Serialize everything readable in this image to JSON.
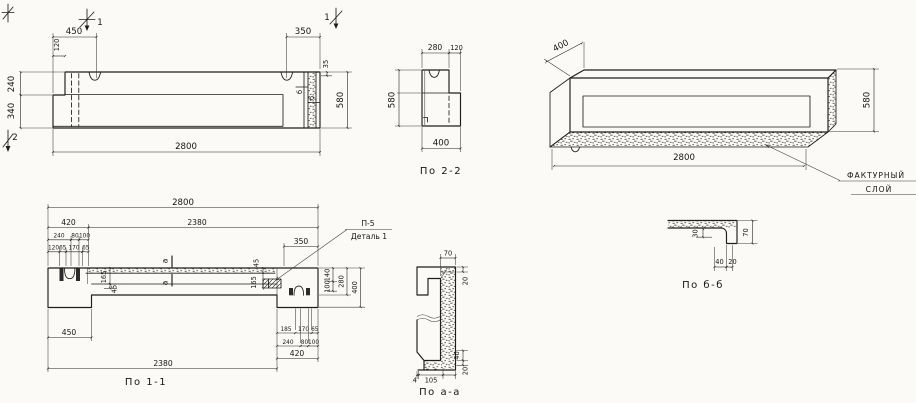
{
  "style": {
    "ink": "#1d1d1d",
    "paper": "#fbfaf6"
  },
  "views": {
    "elevation": {
      "marker_1_left": "1",
      "marker_1_right": "1",
      "marker_2": "2",
      "dim_450": "450",
      "dim_120": "120",
      "dim_350": "350",
      "dim_35": "35",
      "dim_580": "580",
      "dim_2800": "2800",
      "dim_240": "240",
      "dim_340": "340",
      "cut_label_b1": "б",
      "cut_label_b2": "б"
    },
    "section_2_2": {
      "title": "По 2-2",
      "dim_280": "280",
      "dim_120": "120",
      "dim_580": "580",
      "dim_400": "400"
    },
    "axonometric": {
      "dim_400": "400",
      "dim_580": "580",
      "dim_2800": "2800",
      "callout_line1": "ФАКТУРНЫЙ",
      "callout_line2": "СЛОЙ"
    },
    "plan_1_1": {
      "title": "По 1-1",
      "dim_2800": "2800",
      "dim_420_top": "420",
      "dim_2380_top": "2380",
      "dim_240_top": "240",
      "dim_80_top": "80",
      "dim_100_top": "100",
      "dim_120": "120",
      "dim_65_a": "65",
      "dim_170_top": "170",
      "dim_65_b": "65",
      "dim_165_left": "165",
      "dim_45_left": "45",
      "cut_label_a1": "а",
      "cut_label_a2": "а",
      "dim_350": "350",
      "detail_tag": "П-5",
      "detail_name": "Деталь 1",
      "dim_45_right": "45",
      "dim_165_right": "165",
      "dim_140": "140",
      "dim_100_right": "100",
      "dim_280": "280",
      "dim_400": "400",
      "dim_185": "185",
      "dim_170_bot": "170",
      "dim_65_bot": "65",
      "dim_240_bot": "240",
      "dim_80_bot": "80",
      "dim_100_bot": "100",
      "dim_420_bot": "420",
      "dim_450": "450",
      "dim_2380_bot": "2380"
    },
    "section_a_a": {
      "title": "По а-а",
      "dim_70": "70",
      "dim_20_top": "20",
      "dim_40": "40",
      "dim_20_bot": "20",
      "dim_4": "4",
      "dim_105": "105"
    },
    "section_b_b": {
      "title": "По б-б",
      "dim_30": "30",
      "dim_70": "70",
      "dim_40": "40",
      "dim_20": "20"
    }
  }
}
